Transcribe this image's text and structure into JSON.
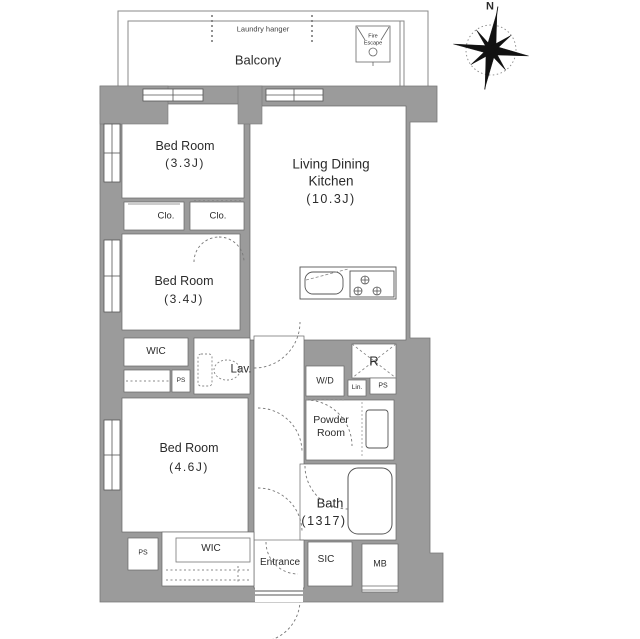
{
  "compass": {
    "north_label": "N"
  },
  "balcony": {
    "label": "Balcony",
    "laundry_hanger": "Laundry hanger",
    "fire_escape": {
      "line1": "Fire",
      "line2": "Escape"
    }
  },
  "rooms": {
    "bedroom_top": {
      "name": "Bed Room",
      "size": "(3.3J)"
    },
    "bedroom_middle": {
      "name": "Bed Room",
      "size": "(3.4J)"
    },
    "bedroom_bottom": {
      "name": "Bed Room",
      "size": "(4.6J)"
    },
    "ldk": {
      "name_line1": "Living Dining",
      "name_line2": "Kitchen",
      "size": "(10.3J)"
    },
    "closet_left": {
      "label": "Clo."
    },
    "closet_right": {
      "label": "Clo."
    },
    "wic_middle": {
      "label": "WIC"
    },
    "wic_bottom": {
      "label": "WIC"
    },
    "lavatory": {
      "label": "Lav."
    },
    "washer_dryer": {
      "label": "W/D"
    },
    "linen": {
      "label": "Lin."
    },
    "refrigerator": {
      "label": "R"
    },
    "pipe_space_middle": {
      "label": "PS"
    },
    "pipe_space_right": {
      "label": "PS"
    },
    "pipe_space_bottom": {
      "label": "PS"
    },
    "powder_room": {
      "name_line1": "Powder",
      "name_line2": "Room"
    },
    "bath": {
      "name": "Bath",
      "size": "(1317)"
    },
    "entrance": {
      "label": "Entrance"
    },
    "shoe_closet": {
      "label": "SIC"
    },
    "meter_box": {
      "label": "MB"
    }
  },
  "colors": {
    "wall": "#9b9b9b",
    "line": "#555555",
    "text": "#2b2b2b",
    "background": "#ffffff"
  }
}
